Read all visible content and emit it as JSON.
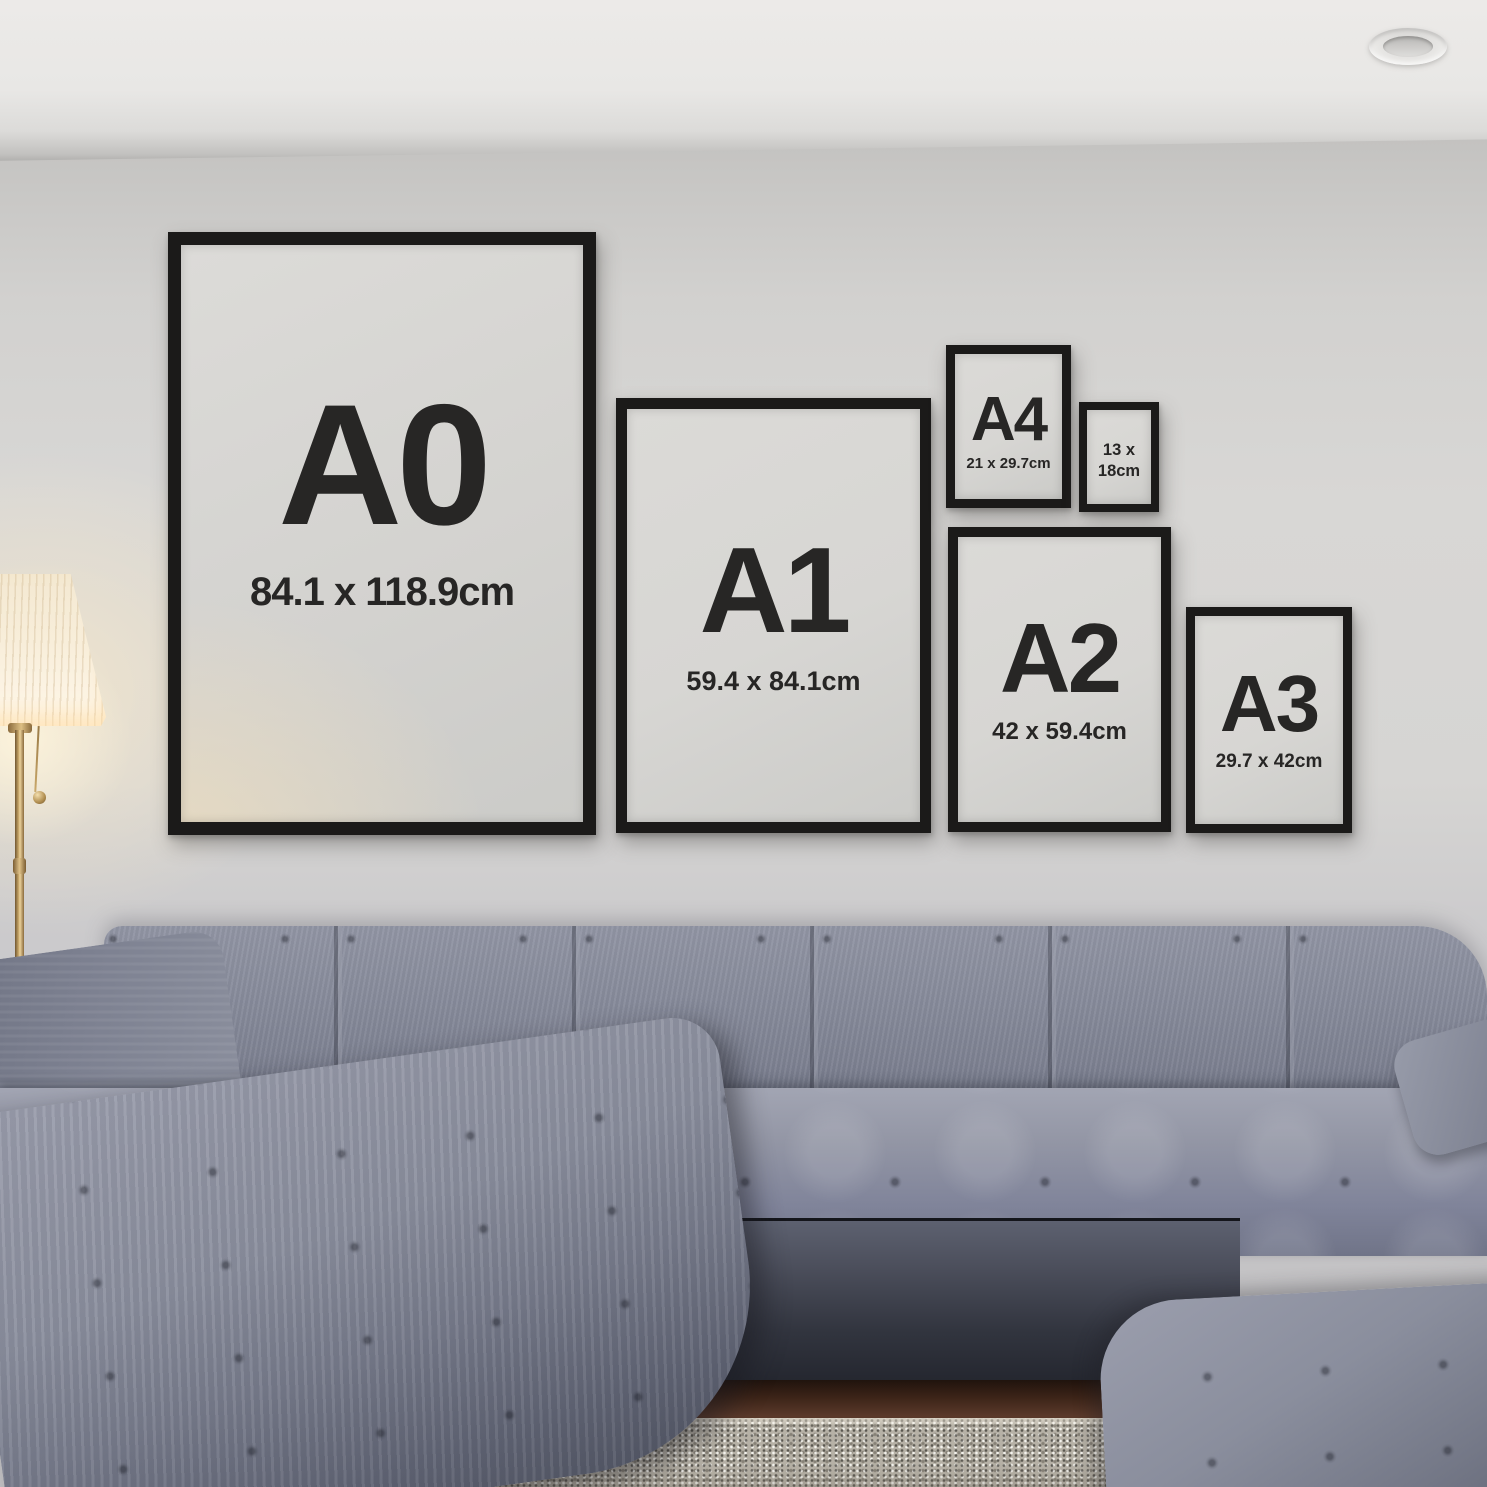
{
  "frames": [
    {
      "label": "A0",
      "dimensions": "84.1 x 118.9cm"
    },
    {
      "label": "A1",
      "dimensions": "59.4 x 84.1cm"
    },
    {
      "label": "A4",
      "dimensions": "21 x 29.7cm"
    },
    {
      "label": "",
      "dimensions": "13 x\n18cm"
    },
    {
      "label": "A2",
      "dimensions": "42 x 59.4cm"
    },
    {
      "label": "A3",
      "dimensions": "29.7 x 42cm"
    }
  ],
  "colors": {
    "wall": "#d5d4d2",
    "ceiling": "#eceae8",
    "frame-border": "#1b1a19",
    "mat": "#d7d6d3",
    "label-text": "#272625",
    "sofa": "#7d8191",
    "sofa-dark": "#4c4f5c",
    "rug": "#b6b1a6",
    "wood": "#4a2f22",
    "brass": "#b08d4f",
    "glow": "#f7e7c6"
  }
}
